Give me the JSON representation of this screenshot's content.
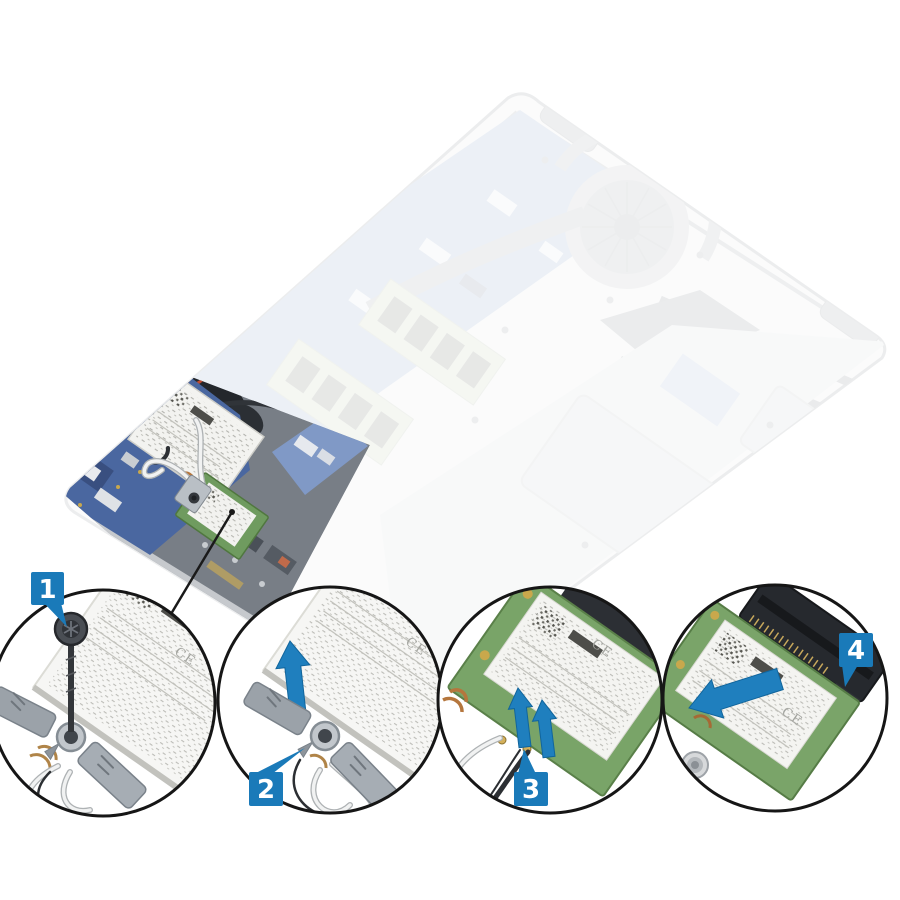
{
  "figure": {
    "kind": "service-illustration",
    "steps": [
      {
        "label": "1"
      },
      {
        "label": "2"
      },
      {
        "label": "3"
      },
      {
        "label": "4"
      }
    ]
  },
  "markings": {
    "ce": "CE"
  },
  "colors": {
    "marker_blue": "#1a7ab9",
    "arrow_blue": "#1f7fbe",
    "arrow_edge": "#11659c",
    "circle_border": "#161616",
    "pcb_green": "#6f9b5f",
    "connector_black": "#26292e",
    "bracket_gray": "#9ba2a9",
    "photo_fade_gray": "#ecedef"
  }
}
